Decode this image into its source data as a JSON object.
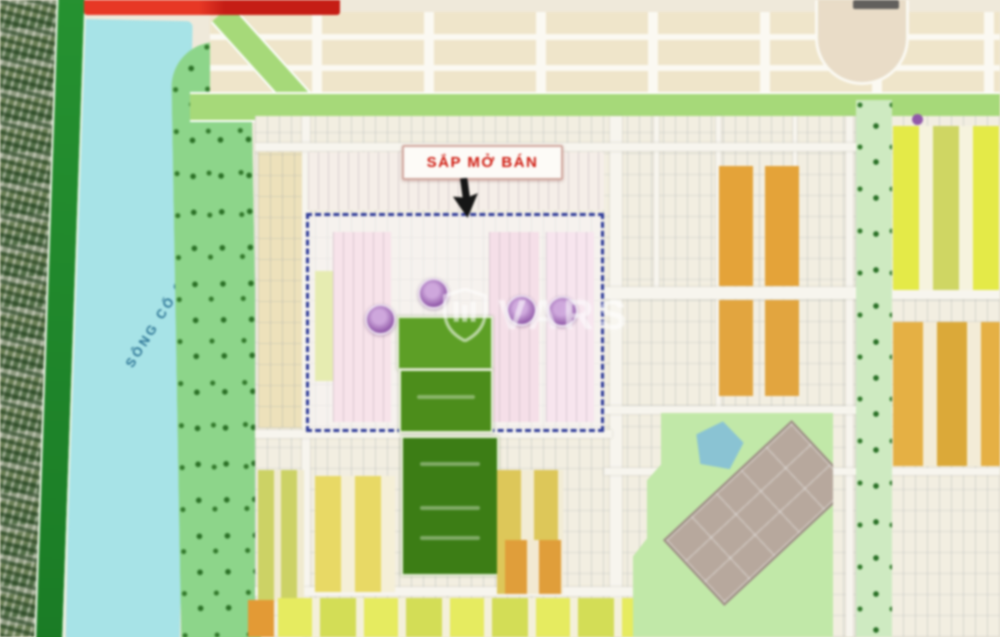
{
  "map": {
    "type": "real-estate-masterplan",
    "watermark": {
      "text": "VARS",
      "icon": "shield-icon"
    },
    "callout": {
      "text": "SẮP MỞ BÁN",
      "text_color": "#c81e14",
      "arrow": "down-arrow-icon"
    },
    "river": {
      "label": "SÔNG CỔ CÒ",
      "label_color": "#1e6286",
      "water_color": "#a9e2e6"
    },
    "amenity_markers": {
      "count": 4,
      "color": "#8f5ba6"
    },
    "palette": {
      "water": "#a9e2e6",
      "riverside_park": "#8fd48d",
      "left_road_green": "#228c2e",
      "boulevard_green": "#a8d87d",
      "cream_lots": "#efe5cb",
      "white_lots": "#f2eee2",
      "pink_lots": "#f6e3ea",
      "orange_lots": "#e1a33e",
      "yellow_lots": "#e4e94f",
      "olive_lots": "#ccd26a",
      "sale_green_dark": "#3e7c19",
      "sale_green_mid": "#4e8c1f",
      "sale_green_light": "#5f9e2b",
      "campus_green": "#c2e7aa",
      "pond_blue": "#8cc2d2",
      "building_gray": "#b6a89e",
      "dashed_border": "#2e3a93",
      "banner_red": "#d63226"
    }
  }
}
